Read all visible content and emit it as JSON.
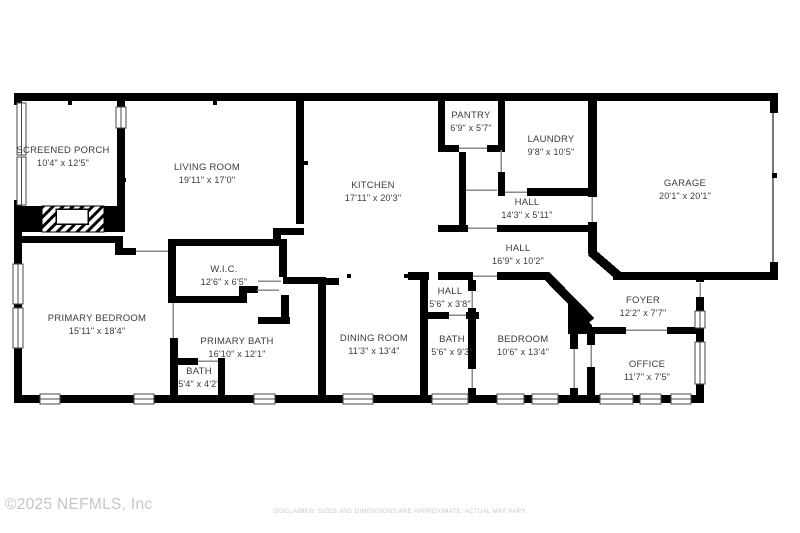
{
  "plan": {
    "rooms": [
      {
        "id": "screened-porch",
        "name": "SCREENED PORCH",
        "dims": "10'4\" x 12'5\""
      },
      {
        "id": "living-room",
        "name": "LIVING ROOM",
        "dims": "19'11\" x 17'0\""
      },
      {
        "id": "kitchen",
        "name": "KITCHEN",
        "dims": "17'11\" x 20'3\""
      },
      {
        "id": "pantry",
        "name": "PANTRY",
        "dims": "6'9\" x 5'7\""
      },
      {
        "id": "laundry",
        "name": "LAUNDRY",
        "dims": "9'8\" x 10'5\""
      },
      {
        "id": "garage",
        "name": "GARAGE",
        "dims": "20'1\" x 20'1\""
      },
      {
        "id": "hall-upper",
        "name": "HALL",
        "dims": "14'3\" x 5'11\""
      },
      {
        "id": "hall-lower",
        "name": "HALL",
        "dims": "16'9\" x 10'2\""
      },
      {
        "id": "wic",
        "name": "W.I.C.",
        "dims": "12'6\" x 6'5\""
      },
      {
        "id": "primary-bedroom",
        "name": "PRIMARY BEDROOM",
        "dims": "15'11\" x 18'4\""
      },
      {
        "id": "primary-bath",
        "name": "PRIMARY BATH",
        "dims": "16'10\" x 12'1\""
      },
      {
        "id": "bath-small",
        "name": "BATH",
        "dims": "5'4\" x 4'2\""
      },
      {
        "id": "dining-room",
        "name": "DINING ROOM",
        "dims": "11'3\" x 13'4\""
      },
      {
        "id": "hall-small",
        "name": "HALL",
        "dims": "5'6\" x 3'8\""
      },
      {
        "id": "bath",
        "name": "BATH",
        "dims": "5'6\" x 9'3\""
      },
      {
        "id": "bedroom",
        "name": "BEDROOM",
        "dims": "10'6\" x 13'4\""
      },
      {
        "id": "foyer",
        "name": "FOYER",
        "dims": "12'2\" x 7'7\""
      },
      {
        "id": "office",
        "name": "OFFICE",
        "dims": "11'7\" x 7'5\""
      }
    ],
    "colors": {
      "wall": "#000000",
      "label": "#3b3b3b",
      "door_line": "#8a8a8a",
      "footer_gray": "#c5c5c5",
      "disclaimer_gray": "#c9c9c9"
    }
  },
  "footer": {
    "copyright": "©2025 NEFMLS, Inc",
    "disclaimer": "DISCLAIMER: SIZES AND DIMENSIONS ARE APPROXIMATE. ACTUAL MAY VARY."
  }
}
